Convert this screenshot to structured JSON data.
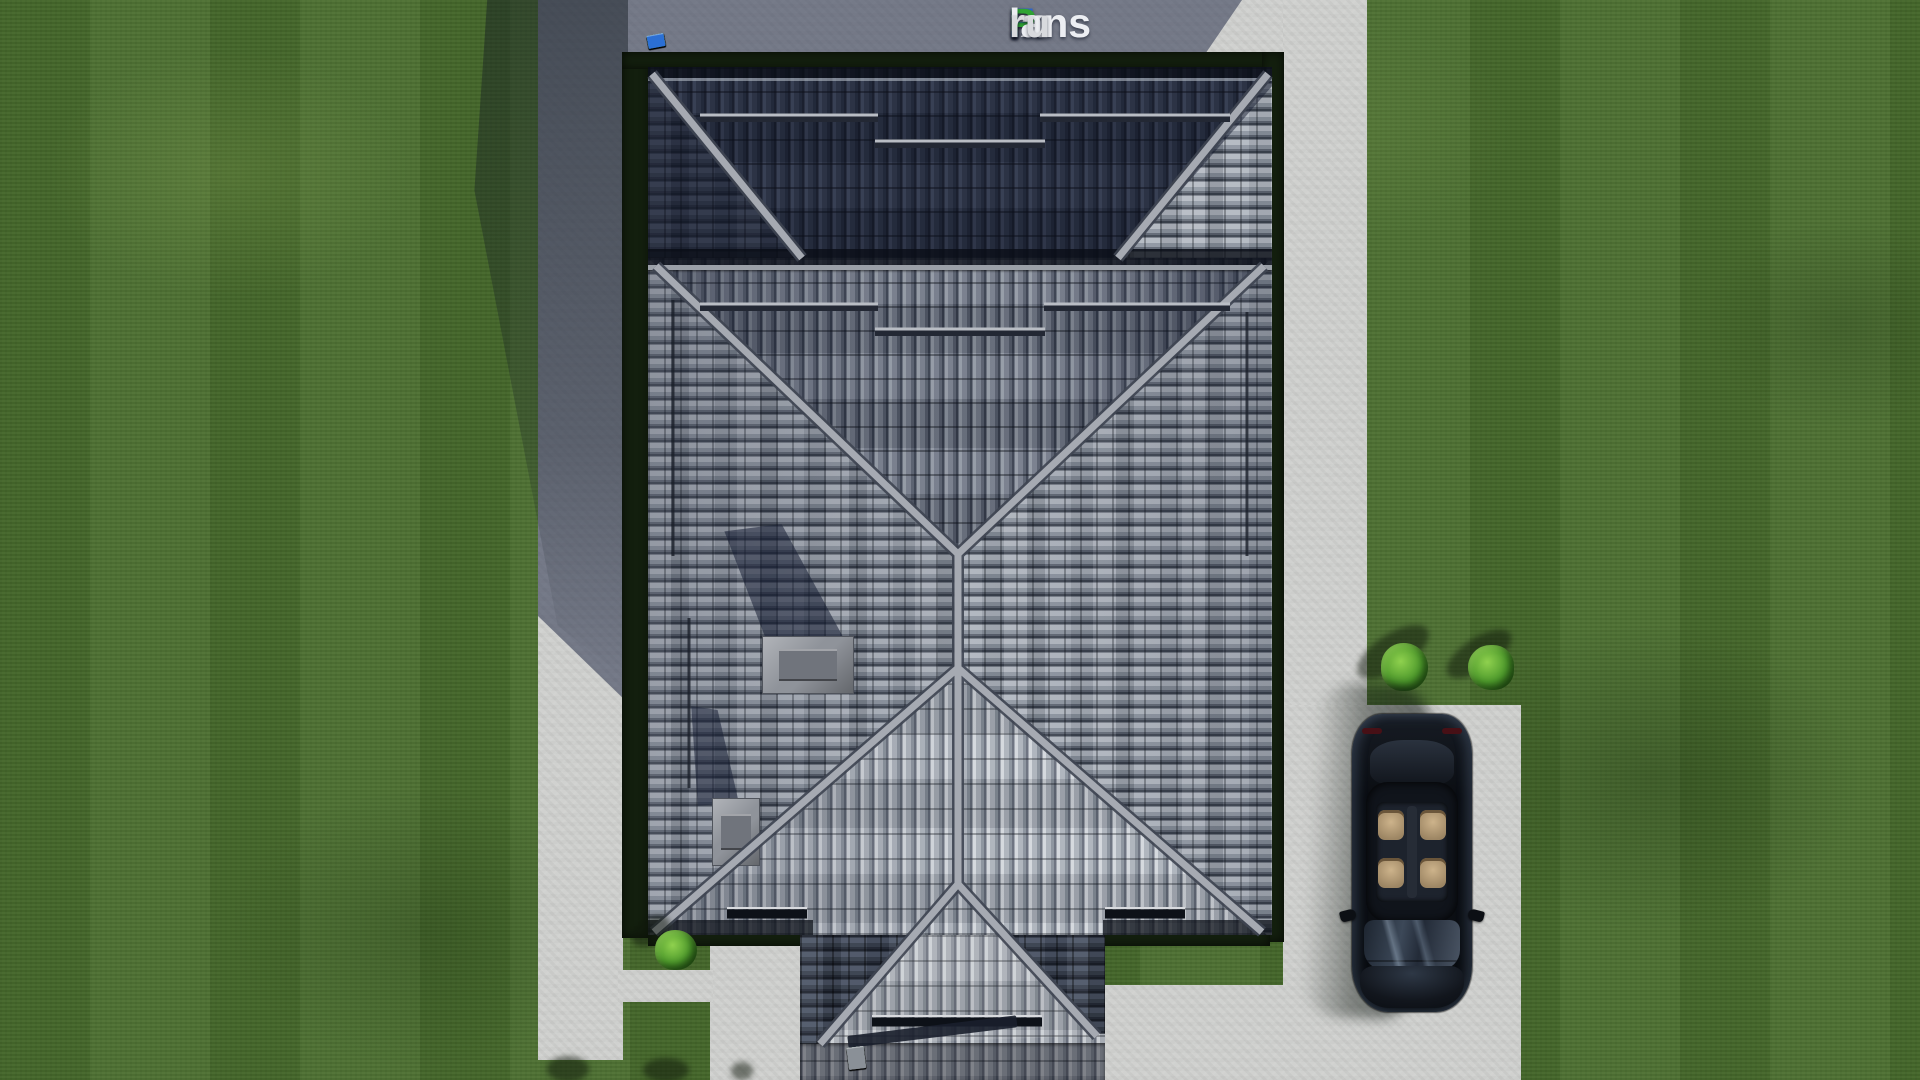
{
  "watermark": {
    "text": "FixPlans.ru",
    "segments": [
      {
        "text": "F",
        "color": "#2f66cc"
      },
      {
        "text": "ix",
        "color": "#eceef2"
      },
      {
        "text": "P",
        "color": "#2fa434"
      },
      {
        "text": "lans",
        "color": "#eceef2"
      },
      {
        "text": ".",
        "color": "#2f66cc"
      },
      {
        "text": "ru",
        "color": "#d8dade"
      }
    ]
  },
  "palette": {
    "lawn": "#4a6e2e",
    "lawn_shadow": "#23321c",
    "concrete": "#d0d1cf",
    "concrete_shadow": "#6d7487",
    "garden_band": "#131f0e",
    "roof_dark": "#2b3140",
    "roof_mid": "#8f95a0",
    "roof_light": "#c9cdd3",
    "ridge": "#a6aab2",
    "accent_blue": "#2b6fd4",
    "accent_green": "#2fae34",
    "tile_blue": "#2ba3e8",
    "tile_green": "#3fc43f",
    "car_body": "#0b0e14",
    "car_interior": "#c0a67e"
  },
  "decor": {
    "top_tile_strip": [
      "#e8eaec",
      "#dde0e3",
      "#2b6fd4",
      "#eceef0",
      "#e4e7e9",
      "#eff1f2",
      "#d9dcdf",
      "#2fae34",
      "#e9ebed",
      "#e0e2e5",
      "#2fae34",
      "#2b6fd4"
    ],
    "porch_eave_tiles": [
      "#2ba3e8",
      "#4fc13c",
      "#e8e9eb",
      "#3fc43f",
      "#eceded",
      "#dfe1e3",
      "#a8adb4",
      "#8a9097"
    ]
  }
}
